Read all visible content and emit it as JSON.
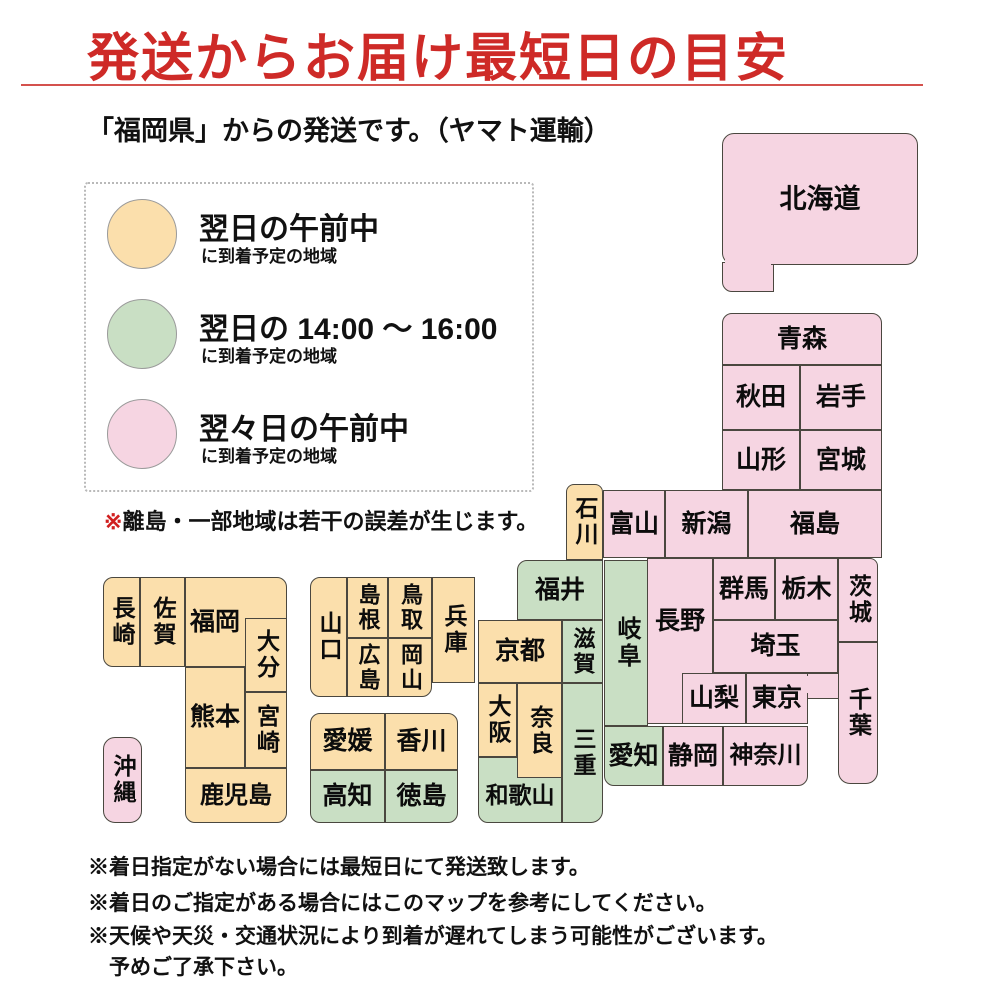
{
  "palette": {
    "orange": "#fbdfac",
    "green": "#c9dfc4",
    "pink": "#f6d5e2",
    "box_border": "#4a473f",
    "title_red": "#ce2a27",
    "underline_red": "#d4514d",
    "note_symbol_red": "#d01f1f"
  },
  "header": {
    "title": "発送からお届け最短日の目安",
    "subtitle": "「福岡県」からの発送です。（ヤマト運輸）"
  },
  "legend": {
    "items": [
      {
        "category": "orange",
        "label": "翌日の午前中",
        "sublabel": "に到着予定の地域",
        "top": 15
      },
      {
        "category": "green",
        "label": "翌日の 14:00 ～ 16:00",
        "sublabel": "に到着予定の地域",
        "top": 115
      },
      {
        "category": "pink",
        "label": "翌々日の午前中",
        "sublabel": "に到着予定の地域",
        "top": 215
      }
    ]
  },
  "map_note": {
    "symbol": "※",
    "text": "離島・一部地域は若干の誤差が生じます。"
  },
  "footnotes": [
    {
      "text": "※着日指定がない場合には最短日にて発送致します。",
      "top": 851
    },
    {
      "text": "※着日のご指定がある場合にはこのマップを参考にしてください。",
      "top": 887
    },
    {
      "text": "※天候や天災・交通状況により到着が遅れてしまう可能性がございます。",
      "top": 920
    },
    {
      "text": "　予めご了承下さい。",
      "top": 951
    }
  ],
  "map": {
    "shapes": [
      {
        "id": "hokkaido-extension",
        "category": "pink",
        "x": 722,
        "y": 262,
        "w": 52,
        "h": 30,
        "radius": "0 0 0 10px"
      },
      {
        "id": "prefecture-hokkaido",
        "label": "北海道",
        "category": "pink",
        "x": 722,
        "y": 133,
        "w": 196,
        "h": 132,
        "radius": "12px",
        "label_size": 27
      },
      {
        "id": "hokkaido-join-cover",
        "category": "pink",
        "x": 725,
        "y": 259,
        "w": 46,
        "h": 8,
        "border": false
      },
      {
        "id": "prefecture-aomori",
        "label": "青森",
        "category": "pink",
        "x": 722,
        "y": 313,
        "w": 160,
        "h": 52,
        "radius": "10px 10px 0 0"
      },
      {
        "id": "prefecture-akita",
        "label": "秋田",
        "category": "pink",
        "x": 722,
        "y": 365,
        "w": 78,
        "h": 65
      },
      {
        "id": "prefecture-iwate",
        "label": "岩手",
        "category": "pink",
        "x": 800,
        "y": 365,
        "w": 82,
        "h": 65
      },
      {
        "id": "prefecture-yamagata",
        "label": "山形",
        "category": "pink",
        "x": 722,
        "y": 430,
        "w": 78,
        "h": 60
      },
      {
        "id": "prefecture-miyagi",
        "label": "宮城",
        "category": "pink",
        "x": 800,
        "y": 430,
        "w": 82,
        "h": 60
      },
      {
        "id": "prefecture-toyama",
        "label": "富山",
        "category": "pink",
        "x": 603,
        "y": 490,
        "w": 62,
        "h": 68
      },
      {
        "id": "prefecture-niigata",
        "label": "新潟",
        "category": "pink",
        "x": 665,
        "y": 490,
        "w": 83,
        "h": 68
      },
      {
        "id": "prefecture-fukushima",
        "label": "福島",
        "category": "pink",
        "x": 748,
        "y": 490,
        "w": 134,
        "h": 68
      },
      {
        "id": "prefecture-ishikawa",
        "label": "石川",
        "category": "orange",
        "x": 566,
        "y": 484,
        "w": 37,
        "h": 76,
        "vertical": true,
        "radius": "8px 8px 0 0",
        "label_size": 23
      },
      {
        "id": "prefecture-fukui",
        "label": "福井",
        "category": "green",
        "x": 517,
        "y": 560,
        "w": 86,
        "h": 60,
        "radius": "10px 0 0 0"
      },
      {
        "id": "prefecture-shiga",
        "label": "滋賀",
        "category": "green",
        "x": 562,
        "y": 620,
        "w": 41,
        "h": 63,
        "vertical": true,
        "label_size": 22
      },
      {
        "id": "prefecture-kyoto",
        "label": "京都",
        "category": "orange",
        "x": 478,
        "y": 620,
        "w": 84,
        "h": 63
      },
      {
        "id": "prefecture-hyogo",
        "label": "兵庫",
        "category": "orange",
        "x": 432,
        "y": 577,
        "w": 43,
        "h": 106,
        "vertical": true,
        "label_size": 23
      },
      {
        "id": "prefecture-wakayama",
        "label": "和歌山",
        "category": "green",
        "x": 478,
        "y": 757,
        "w": 84,
        "h": 66,
        "radius": "0 0 0 10px",
        "label_inset": "18% 0 0 0",
        "label_size": 23
      },
      {
        "id": "prefecture-osaka",
        "label": "大阪",
        "category": "orange",
        "x": 478,
        "y": 683,
        "w": 39,
        "h": 74,
        "vertical": true,
        "label_size": 23
      },
      {
        "id": "prefecture-nara",
        "label": "奈良",
        "category": "orange",
        "x": 517,
        "y": 683,
        "w": 45,
        "h": 95,
        "vertical": true,
        "label_size": 23
      },
      {
        "id": "prefecture-mie",
        "label": "三重",
        "category": "green",
        "x": 562,
        "y": 683,
        "w": 41,
        "h": 140,
        "vertical": true,
        "radius": "0 0 12px 0",
        "label_size": 23
      },
      {
        "id": "prefecture-gifu",
        "label": "岐阜",
        "category": "green",
        "x": 604,
        "y": 560,
        "w": 44,
        "h": 166,
        "vertical": true,
        "label_size": 24
      },
      {
        "id": "prefecture-aichi",
        "label": "愛知",
        "category": "green",
        "x": 604,
        "y": 726,
        "w": 59,
        "h": 60,
        "radius": "0 0 0 10px"
      },
      {
        "id": "prefecture-shizuoka",
        "label": "静岡",
        "category": "pink",
        "x": 663,
        "y": 726,
        "w": 60,
        "h": 60
      },
      {
        "id": "prefecture-nagano",
        "label": "長野",
        "category": "pink",
        "x": 647,
        "y": 558,
        "w": 66,
        "h": 166,
        "label_inset": "0 0 24% 0"
      },
      {
        "id": "prefecture-yamanashi",
        "label": "山梨",
        "category": "pink",
        "x": 682,
        "y": 673,
        "w": 64,
        "h": 51
      },
      {
        "id": "prefecture-gunma",
        "label": "群馬",
        "category": "pink",
        "x": 713,
        "y": 558,
        "w": 62,
        "h": 62
      },
      {
        "id": "prefecture-tochigi",
        "label": "栃木",
        "category": "pink",
        "x": 775,
        "y": 558,
        "w": 63,
        "h": 62
      },
      {
        "id": "prefecture-ibaraki",
        "label": "茨城",
        "category": "pink",
        "x": 838,
        "y": 558,
        "w": 40,
        "h": 84,
        "vertical": true,
        "radius": "0 8px 0 0",
        "label_size": 23
      },
      {
        "id": "prefecture-saitama",
        "label": "埼玉",
        "category": "pink",
        "x": 713,
        "y": 620,
        "w": 125,
        "h": 53
      },
      {
        "id": "tokyo-chiba-connector",
        "category": "pink",
        "x": 806,
        "y": 673,
        "w": 34,
        "h": 26
      },
      {
        "id": "prefecture-tokyo",
        "label": "東京",
        "category": "pink",
        "x": 746,
        "y": 673,
        "w": 62,
        "h": 51
      },
      {
        "id": "tokyo-join-cover",
        "category": "pink",
        "x": 804,
        "y": 676,
        "w": 8,
        "h": 17,
        "border": false
      },
      {
        "id": "prefecture-chiba",
        "label": "千葉",
        "category": "pink",
        "x": 838,
        "y": 642,
        "w": 40,
        "h": 142,
        "vertical": true,
        "radius": "0 0 12px 12px",
        "label_size": 23
      },
      {
        "id": "prefecture-kanagawa",
        "label": "神奈川",
        "category": "pink",
        "x": 723,
        "y": 726,
        "w": 85,
        "h": 60,
        "radius": "0 0 10px 0",
        "label_size": 24
      },
      {
        "id": "prefecture-yamaguchi",
        "label": "山口",
        "category": "orange",
        "x": 310,
        "y": 577,
        "w": 37,
        "h": 120,
        "vertical": true,
        "radius": "10px 0 0 10px",
        "label_size": 23
      },
      {
        "id": "prefecture-shimane",
        "label": "島根",
        "category": "orange",
        "x": 347,
        "y": 577,
        "w": 41,
        "h": 61,
        "vertical": true,
        "label_size": 22
      },
      {
        "id": "prefecture-tottori",
        "label": "鳥取",
        "category": "orange",
        "x": 388,
        "y": 577,
        "w": 44,
        "h": 61,
        "vertical": true,
        "label_size": 22
      },
      {
        "id": "prefecture-hiroshima",
        "label": "広島",
        "category": "orange",
        "x": 347,
        "y": 638,
        "w": 41,
        "h": 59,
        "vertical": true,
        "label_size": 22
      },
      {
        "id": "prefecture-okayama",
        "label": "岡山",
        "category": "orange",
        "x": 388,
        "y": 638,
        "w": 44,
        "h": 59,
        "vertical": true,
        "radius": "0 0 10px 0",
        "label_size": 22
      },
      {
        "id": "prefecture-ehime",
        "label": "愛媛",
        "category": "orange",
        "x": 310,
        "y": 713,
        "w": 75,
        "h": 57,
        "radius": "10px 0 0 0"
      },
      {
        "id": "prefecture-kagawa",
        "label": "香川",
        "category": "orange",
        "x": 385,
        "y": 713,
        "w": 73,
        "h": 57,
        "radius": "0 10px 0 0"
      },
      {
        "id": "prefecture-kochi",
        "label": "高知",
        "category": "green",
        "x": 310,
        "y": 770,
        "w": 75,
        "h": 53,
        "radius": "0 0 0 10px"
      },
      {
        "id": "prefecture-tokushima",
        "label": "徳島",
        "category": "green",
        "x": 385,
        "y": 770,
        "w": 73,
        "h": 53,
        "radius": "0 0 10px 0"
      },
      {
        "id": "prefecture-nagasaki",
        "label": "長崎",
        "category": "orange",
        "x": 103,
        "y": 577,
        "w": 37,
        "h": 90,
        "vertical": true,
        "radius": "10px 0 0 10px",
        "label_size": 23
      },
      {
        "id": "prefecture-saga",
        "label": "佐賀",
        "category": "orange",
        "x": 140,
        "y": 577,
        "w": 45,
        "h": 90,
        "vertical": true,
        "label_size": 23
      },
      {
        "id": "prefecture-fukuoka",
        "label": "福岡",
        "category": "orange",
        "x": 185,
        "y": 577,
        "w": 102,
        "h": 90,
        "radius": "0 10px 0 0",
        "label_inset": "0 42% 0 0"
      },
      {
        "id": "prefecture-oita",
        "label": "大分",
        "category": "orange",
        "x": 245,
        "y": 618,
        "w": 42,
        "h": 74,
        "vertical": true,
        "label_size": 23
      },
      {
        "id": "prefecture-kumamoto",
        "label": "熊本",
        "category": "orange",
        "x": 185,
        "y": 667,
        "w": 60,
        "h": 101
      },
      {
        "id": "prefecture-miyazaki",
        "label": "宮崎",
        "category": "orange",
        "x": 245,
        "y": 692,
        "w": 42,
        "h": 76,
        "vertical": true,
        "label_size": 23
      },
      {
        "id": "prefecture-kagoshima",
        "label": "鹿児島",
        "category": "orange",
        "x": 185,
        "y": 768,
        "w": 102,
        "h": 55,
        "radius": "0 0 10px 10px",
        "label_size": 24
      },
      {
        "id": "prefecture-okinawa",
        "label": "沖縄",
        "category": "pink",
        "x": 103,
        "y": 737,
        "w": 39,
        "h": 86,
        "vertical": true,
        "radius": "12px",
        "label_size": 23
      }
    ]
  }
}
